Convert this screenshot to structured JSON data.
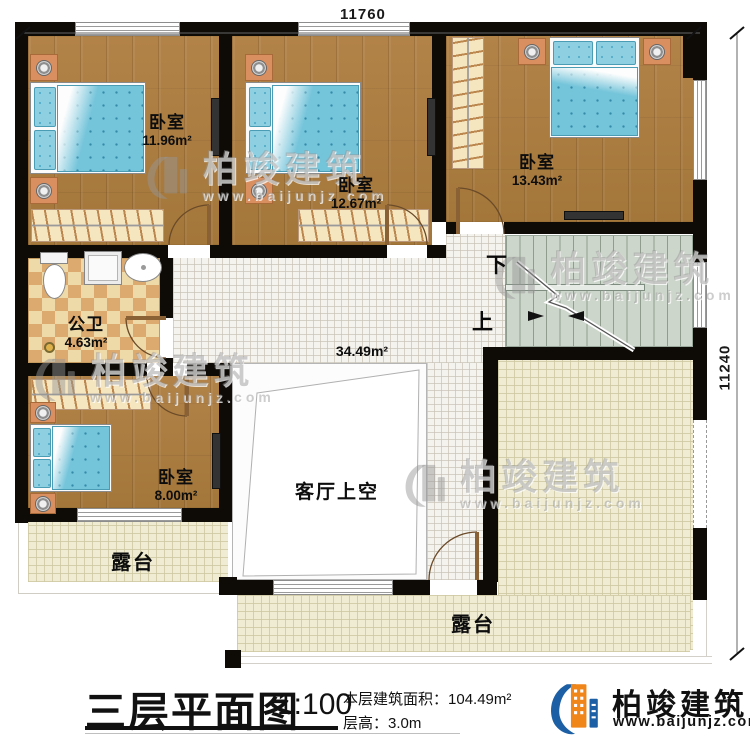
{
  "dimensions": {
    "top": "11760",
    "right": "11240"
  },
  "rooms": {
    "bedroom1": {
      "name": "卧室",
      "area": "11.96m²"
    },
    "bedroom2": {
      "name": "卧室",
      "area": "12.67m²"
    },
    "bedroom3": {
      "name": "卧室",
      "area": "13.43m²"
    },
    "bedroom4": {
      "name": "卧室",
      "area": "8.00m²"
    },
    "bathroom": {
      "name": "公卫",
      "area": "4.63m²"
    },
    "living_void": {
      "name": "客厅上空",
      "area": "34.49m²"
    },
    "terrace_left": {
      "name": "露台"
    },
    "terrace_bottom": {
      "name": "露台"
    }
  },
  "stairs": {
    "down_label": "下",
    "up_label": "上"
  },
  "watermark": {
    "brand": "柏竣建筑",
    "url": "www.baijunjz.com"
  },
  "title_block": {
    "title": "三层平面图",
    "scale": "1:100",
    "floor_area_label": "本层建筑面积：",
    "floor_area_value": "104.49m²",
    "floor_height_label": "层高：",
    "floor_height_value": "3.0m",
    "brand": "柏竣建筑",
    "brand_url": "www.baijunjz.com"
  },
  "colors": {
    "wall": "#0e0b07",
    "wood_floor": "#aa7d40",
    "bed_blue": "#74c4da",
    "stair_green": "#cdd6cb",
    "terrace_cream": "#efecd3",
    "bath_tile": "#dcaa6e",
    "brand_blue": "#1c5fa5",
    "brand_orange": "#f08519"
  }
}
